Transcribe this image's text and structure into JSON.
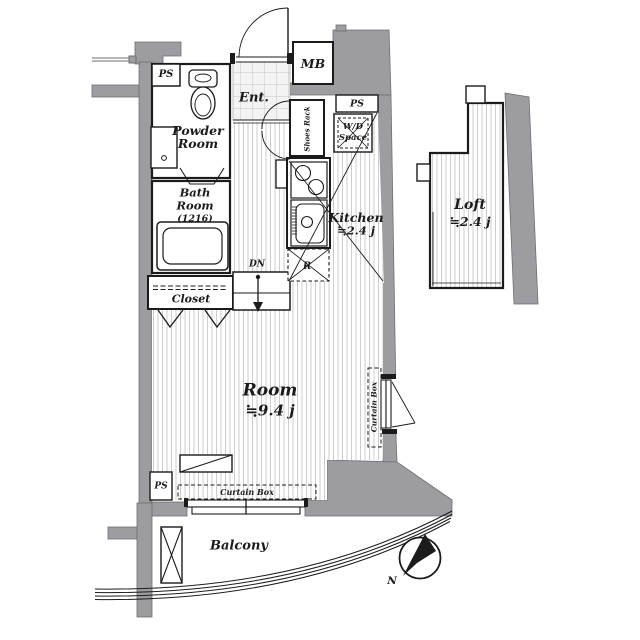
{
  "labels": {
    "ps_top": "PS",
    "powder_room": [
      "Powder",
      "Room"
    ],
    "ent": "Ent.",
    "mb": "MB",
    "shoes_rack": "Shoes Rack",
    "ps_right": "PS",
    "wd_space": [
      "W/D",
      "Space"
    ],
    "bath_room": [
      "Bath",
      "Room",
      "(1216)"
    ],
    "kitchen": [
      "Kitchen",
      "≒2.4 j"
    ],
    "dn": "DN",
    "refrigerator": "R",
    "closet": "Closet",
    "room": [
      "Room",
      "≒9.4 j"
    ],
    "curtain_box_right": "Curtain Box",
    "curtain_box_bottom": "Curtain Box",
    "ps_bottom": "PS",
    "balcony": "Balcony",
    "loft": [
      "Loft",
      "≒2.4 j"
    ],
    "compass_n": "N"
  },
  "colors": {
    "wall_gray": "#9c9ca1",
    "line_black": "#1b1b1b",
    "floor_hatch": "#c7c7c7"
  }
}
